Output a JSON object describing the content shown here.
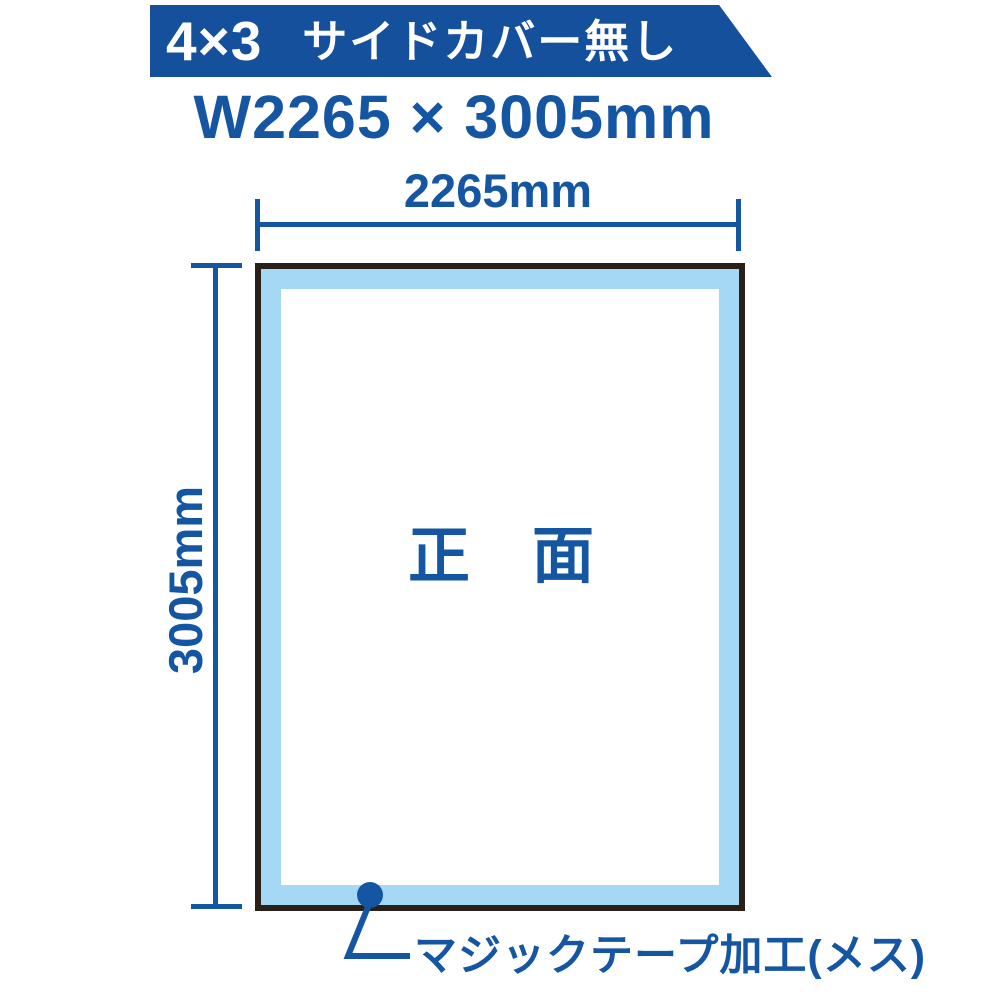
{
  "colors": {
    "banner-blue": "#15509d",
    "accent-blue": "#1456a2",
    "light-blue": "#a5d8f4",
    "frame-black": "#292019",
    "white": "#ffffff"
  },
  "banner": {
    "size_label": "4×3",
    "name_label": "サイドカバー無し"
  },
  "title": {
    "text": "W2265 × 3005mm"
  },
  "diagram": {
    "width_label": "2265mm",
    "height_label": "3005mm",
    "panel_label": "正　面",
    "callout_label": "マジックテープ加工(メス)"
  }
}
